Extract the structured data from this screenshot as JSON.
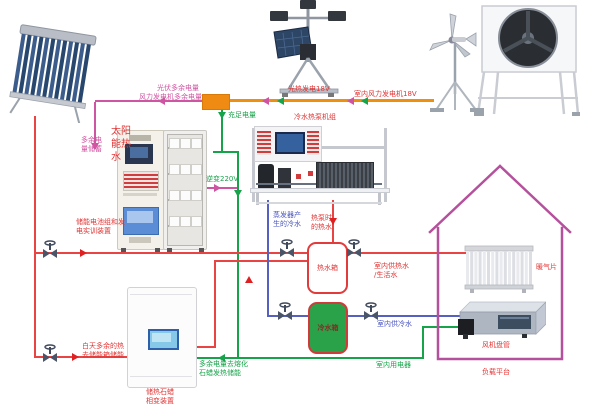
{
  "diagram_title": "太阳能/风能/热泵综合能源实训系统图",
  "colors": {
    "hot_water_pipe": "#e23535",
    "chilled_water_pipe": "#4a55c0",
    "power_wire_green": "#17a34a",
    "power_wire_pink": "#cf55a2",
    "power_bus_orange": "#ef8f0e",
    "house_outline": "#b5509c",
    "cold_tank_fill": "#29a24a"
  },
  "labels": {
    "pv_surplus": "光伏多余电量",
    "wind_surplus": "风力发电机多余电量",
    "surplus_storage": "多余电量储蓄",
    "sufficient_power": "充足电量",
    "pv_generation": "光热发电18V",
    "wind_generation": "室内风力发电机18V",
    "heat_pump_unit": "冷水热泵机组",
    "inverter": "逆变220V",
    "battery_cabinet": "储能电池组和发\n电实训装置",
    "solar_hot_water": "太阳能热水",
    "evaporator_cold_water": "蒸发器产\n生的冷水",
    "heat_pump_hot_water": "热泵时\n的热水",
    "hot_tank": "热水箱",
    "indoor_hot_supply": "室内供热水\n/生活水",
    "radiator": "暖气片",
    "cold_tank": "冷水箱",
    "indoor_cold_supply": "室内供冷水",
    "fan_coil": "风机盘管",
    "indoor_appliances": "室内用电器",
    "melt_paraffin": "多余电量去熔化\n石蜡发热储能",
    "daytime_surplus_heat": "白天多余的热\n去储能箱储能",
    "paraffin_device": "储热石蜡\n相变装置",
    "load_platform": "负载平台"
  }
}
